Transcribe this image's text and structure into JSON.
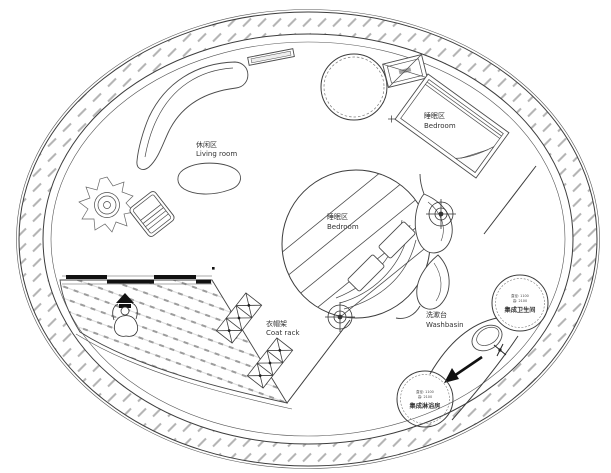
{
  "page": {
    "background": "#ffffff"
  },
  "plan": {
    "type": "circular-floor-plan",
    "areas": {
      "living_room": {
        "label_zh": "休闲区",
        "label_en": "Living room"
      },
      "bedroom_upper": {
        "label_zh": "睡眠区",
        "label_en": "Bedroom"
      },
      "bedroom_center": {
        "label_zh": "睡眠区",
        "label_en": "Bedroom"
      },
      "coat_rack": {
        "label_zh": "衣帽架",
        "label_en": "Coat rack"
      },
      "washbasin": {
        "label_zh": "洗漱台",
        "label_en": "Washbasin"
      },
      "toilet_pod": {
        "dim_diameter": "直径: 1100",
        "dim_height": "高: 2100",
        "label_zh": "集成卫生间"
      },
      "shower_pod": {
        "dim_diameter": "直径: 1100",
        "dim_height": "高: 2100",
        "label_zh": "集成淋浴房"
      }
    },
    "colors": {
      "line": "#3c3c3c",
      "hatch": "#b5b5b5",
      "text": "#333333",
      "background": "#ffffff"
    }
  }
}
